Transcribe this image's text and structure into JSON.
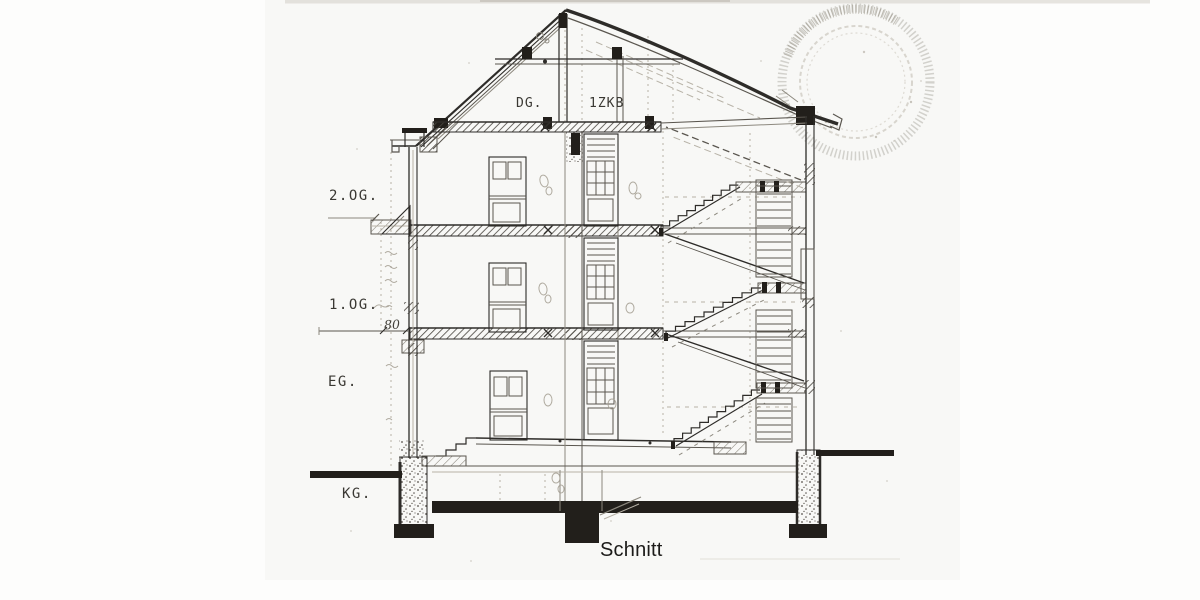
{
  "caption": "Schnitt",
  "floors": [
    {
      "id": "dg",
      "label": "DG.",
      "unit_note": "1ZKB"
    },
    {
      "id": "og2",
      "label": "2.OG."
    },
    {
      "id": "og1",
      "label": "1.OG."
    },
    {
      "id": "eg",
      "label": "EG."
    },
    {
      "id": "kg",
      "label": "KG."
    }
  ],
  "dimension_annotations": [
    "80"
  ],
  "stamp": {
    "shape": "circular",
    "text_legible": false
  },
  "colors": {
    "ink": "#2e2c29",
    "paper": "#f4f3ef",
    "caption_ink": "#1c1b19"
  }
}
